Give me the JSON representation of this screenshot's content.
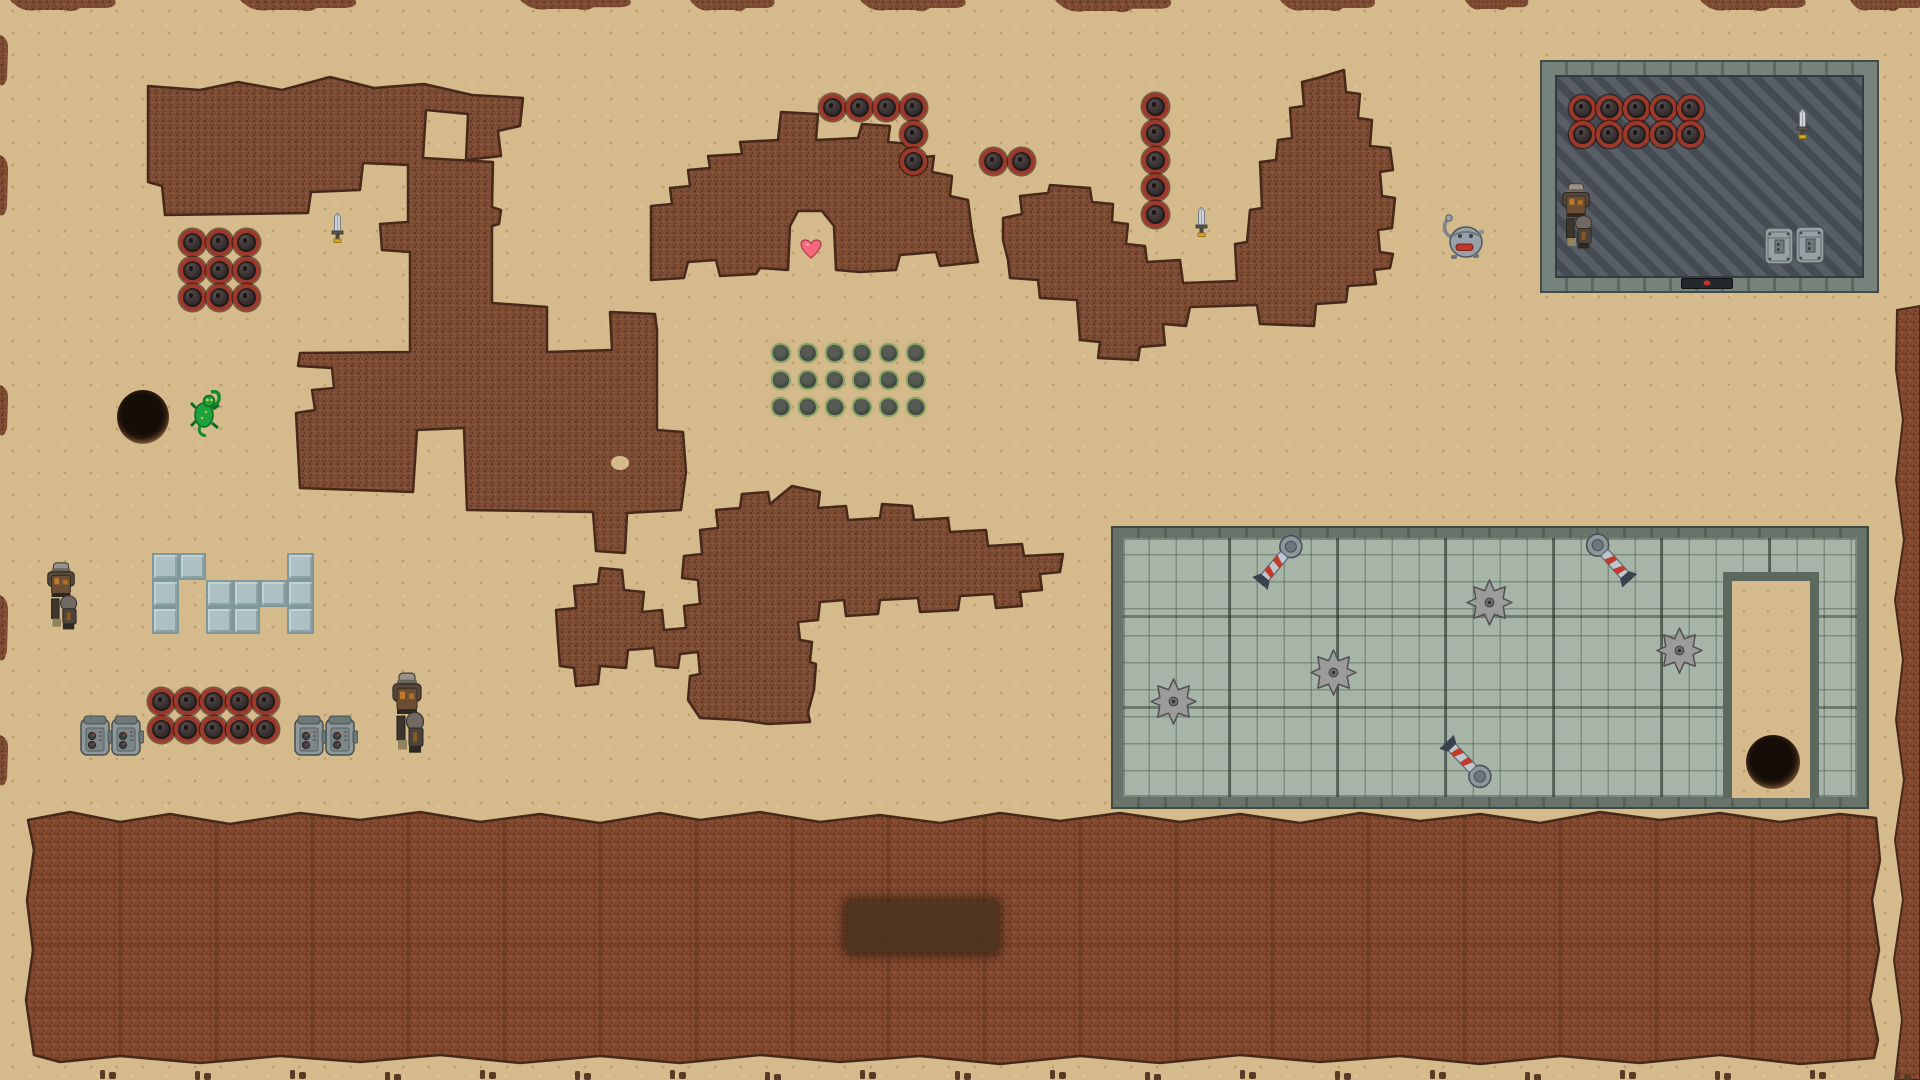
{
  "meta": {
    "scene": "desert-mining-game-map"
  },
  "colors": {
    "sand": "#d5ba8c",
    "dirt": "#7d4c33",
    "dirt_dark": "#5a3522",
    "dirt_light": "#916045",
    "dirt_edge": "#46291a",
    "field": "#82492f",
    "field_dark": "#5e3320",
    "field_light": "#96573a",
    "mine_rim": "#9c392a",
    "room_wall": "#76827c",
    "room_wall_dark": "#5d6862",
    "room_floor_a": "#575e65",
    "room_floor_b": "#454b52",
    "stone": "#a7b5a8",
    "stone_wall": "#68746b",
    "blue_tile": "#adc0c3",
    "blue_tile_edge": "#7f989c",
    "saw": "#9b9b9b",
    "rocket_red": "#c23b2a",
    "heart": "#f4697b",
    "lizard": "#1da23e",
    "patch": "#4e3520"
  },
  "layout": {
    "width": 1920,
    "height": 1080,
    "hatched_room": {
      "x": 1542,
      "y": 62,
      "w": 335,
      "h": 229
    },
    "stone_area": {
      "x": 1113,
      "y": 528,
      "w": 754,
      "h": 279
    },
    "stone_notch": {
      "x": 1723,
      "y": 572,
      "w": 96,
      "h": 226
    },
    "dark_patch": {
      "x": 847,
      "y": 902,
      "w": 150,
      "h": 50
    },
    "blue_tiles": {
      "origin_x": 152,
      "origin_y": 553,
      "tile": 27,
      "cells": [
        [
          0,
          0
        ],
        [
          1,
          0
        ],
        [
          5,
          0
        ],
        [
          0,
          1
        ],
        [
          2,
          1
        ],
        [
          3,
          1
        ],
        [
          4,
          1
        ],
        [
          5,
          1
        ],
        [
          0,
          2
        ],
        [
          2,
          2
        ],
        [
          3,
          2
        ],
        [
          5,
          2
        ]
      ]
    },
    "plant_grid": {
      "origin_x": 781,
      "origin_y": 353,
      "dx": 27,
      "dy": 27,
      "cols": 6,
      "rows": 3
    }
  },
  "sprites": {
    "mine": {
      "w": 27,
      "h": 27,
      "interactable": true
    },
    "sword": {
      "w": 13,
      "h": 30,
      "interactable": true
    },
    "heart": {
      "w": 22,
      "h": 20,
      "interactable": true
    },
    "lizard": {
      "w": 32,
      "h": 48,
      "interactable": true
    },
    "robot": {
      "w": 46,
      "h": 50,
      "interactable": true
    },
    "armored": {
      "w": 36,
      "h": 80,
      "interactable": true
    },
    "machine": {
      "w": 33,
      "h": 42,
      "interactable": true
    },
    "crate": {
      "w": 30,
      "h": 40,
      "interactable": true
    },
    "saw": {
      "w": 47,
      "h": 47,
      "interactable": true
    },
    "rocket": {
      "w": 26,
      "h": 64,
      "interactable": true
    },
    "hole": {
      "w": 52,
      "h": 52,
      "interactable": true
    },
    "door": {
      "w": 52,
      "h": 11,
      "interactable": true
    }
  },
  "entities": [
    {
      "type": "mine",
      "x": 192,
      "y": 242
    },
    {
      "type": "mine",
      "x": 219,
      "y": 242
    },
    {
      "type": "mine",
      "x": 246,
      "y": 242
    },
    {
      "type": "mine",
      "x": 192,
      "y": 270
    },
    {
      "type": "mine",
      "x": 219,
      "y": 270
    },
    {
      "type": "mine",
      "x": 246,
      "y": 270
    },
    {
      "type": "mine",
      "x": 192,
      "y": 297
    },
    {
      "type": "mine",
      "x": 219,
      "y": 297
    },
    {
      "type": "mine",
      "x": 246,
      "y": 297
    },
    {
      "type": "mine",
      "x": 832,
      "y": 107
    },
    {
      "type": "mine",
      "x": 859,
      "y": 107
    },
    {
      "type": "mine",
      "x": 886,
      "y": 107
    },
    {
      "type": "mine",
      "x": 913,
      "y": 107
    },
    {
      "type": "mine",
      "x": 913,
      "y": 134
    },
    {
      "type": "mine",
      "x": 913,
      "y": 161
    },
    {
      "type": "mine",
      "x": 993,
      "y": 161
    },
    {
      "type": "mine",
      "x": 1021,
      "y": 161
    },
    {
      "type": "mine",
      "x": 1155,
      "y": 106
    },
    {
      "type": "mine",
      "x": 1155,
      "y": 133
    },
    {
      "type": "mine",
      "x": 1155,
      "y": 160
    },
    {
      "type": "mine",
      "x": 1155,
      "y": 187
    },
    {
      "type": "mine",
      "x": 1155,
      "y": 214
    },
    {
      "type": "mine",
      "x": 1582,
      "y": 108
    },
    {
      "type": "mine",
      "x": 1609,
      "y": 108
    },
    {
      "type": "mine",
      "x": 1636,
      "y": 108
    },
    {
      "type": "mine",
      "x": 1663,
      "y": 108
    },
    {
      "type": "mine",
      "x": 1690,
      "y": 108
    },
    {
      "type": "mine",
      "x": 1582,
      "y": 134
    },
    {
      "type": "mine",
      "x": 1609,
      "y": 134
    },
    {
      "type": "mine",
      "x": 1636,
      "y": 134
    },
    {
      "type": "mine",
      "x": 1663,
      "y": 134
    },
    {
      "type": "mine",
      "x": 1690,
      "y": 134
    },
    {
      "type": "mine",
      "x": 161,
      "y": 701
    },
    {
      "type": "mine",
      "x": 187,
      "y": 701
    },
    {
      "type": "mine",
      "x": 213,
      "y": 701
    },
    {
      "type": "mine",
      "x": 239,
      "y": 701
    },
    {
      "type": "mine",
      "x": 265,
      "y": 701
    },
    {
      "type": "mine",
      "x": 161,
      "y": 729
    },
    {
      "type": "mine",
      "x": 187,
      "y": 729
    },
    {
      "type": "mine",
      "x": 213,
      "y": 729
    },
    {
      "type": "mine",
      "x": 239,
      "y": 729
    },
    {
      "type": "mine",
      "x": 265,
      "y": 729
    },
    {
      "type": "sword",
      "x": 337,
      "y": 228
    },
    {
      "type": "sword",
      "x": 1201,
      "y": 222
    },
    {
      "type": "sword",
      "x": 1802,
      "y": 124
    },
    {
      "type": "hole",
      "x": 143,
      "y": 417,
      "w": 52,
      "h": 54
    },
    {
      "type": "hole",
      "x": 1773,
      "y": 762,
      "w": 54,
      "h": 54
    },
    {
      "type": "lizard",
      "x": 206,
      "y": 413
    },
    {
      "type": "heart",
      "x": 811,
      "y": 249
    },
    {
      "type": "robot",
      "x": 1462,
      "y": 237
    },
    {
      "type": "armored",
      "x": 61,
      "y": 597,
      "w": 34,
      "h": 72
    },
    {
      "type": "armored",
      "x": 407,
      "y": 714,
      "w": 36,
      "h": 86
    },
    {
      "type": "armored",
      "x": 1576,
      "y": 217,
      "w": 34,
      "h": 70
    },
    {
      "type": "machine",
      "x": 96,
      "y": 736
    },
    {
      "type": "machine",
      "x": 127,
      "y": 736
    },
    {
      "type": "machine",
      "x": 310,
      "y": 736
    },
    {
      "type": "machine",
      "x": 341,
      "y": 736
    },
    {
      "type": "crate",
      "x": 1779,
      "y": 246
    },
    {
      "type": "crate",
      "x": 1810,
      "y": 245
    },
    {
      "type": "door",
      "x": 1707,
      "y": 283
    },
    {
      "type": "saw",
      "x": 1173,
      "y": 701
    },
    {
      "type": "saw",
      "x": 1333,
      "y": 672
    },
    {
      "type": "saw",
      "x": 1489,
      "y": 602
    },
    {
      "type": "saw",
      "x": 1679,
      "y": 650
    },
    {
      "type": "rocket",
      "x": 1278,
      "y": 562,
      "rot": 40
    },
    {
      "type": "rocket",
      "x": 1611,
      "y": 560,
      "rot": -42
    },
    {
      "type": "rocket",
      "x": 1466,
      "y": 762,
      "rot": 136
    }
  ]
}
